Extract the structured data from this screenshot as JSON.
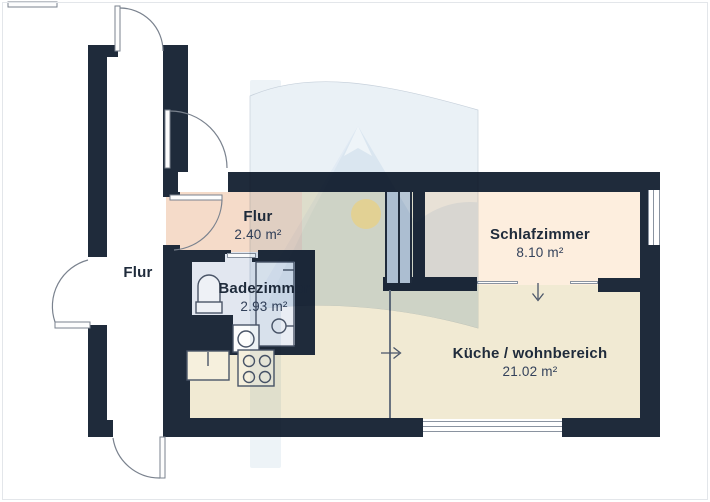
{
  "plan_title": "Grundriss",
  "rooms": {
    "corridor": {
      "label": "Flur"
    },
    "entry": {
      "label": "Flur",
      "area": "2.40 m²"
    },
    "bathroom": {
      "label": "Badezimmer",
      "area": "2.93 m²"
    },
    "bedroom": {
      "label": "Schlafzimmer",
      "area": "8.10 m²"
    },
    "living": {
      "label": "Küche / wohnbereich",
      "area": "21.02 m²"
    }
  },
  "colors": {
    "wall": "#1f2b3b",
    "entry_floor": "#f5dbc9",
    "bathroom_floor": "#e2e7f0",
    "bedroom_floor": "#fdeede",
    "living_floor": "#f1ead3",
    "corridor_floor": "#ffffff",
    "fixture_line": "#4a5568",
    "door_line": "#7a828e",
    "watermark_blue": "#e9f0f6",
    "watermark_mountain": "#d7e4ef",
    "watermark_sun": "#efe2ad"
  }
}
